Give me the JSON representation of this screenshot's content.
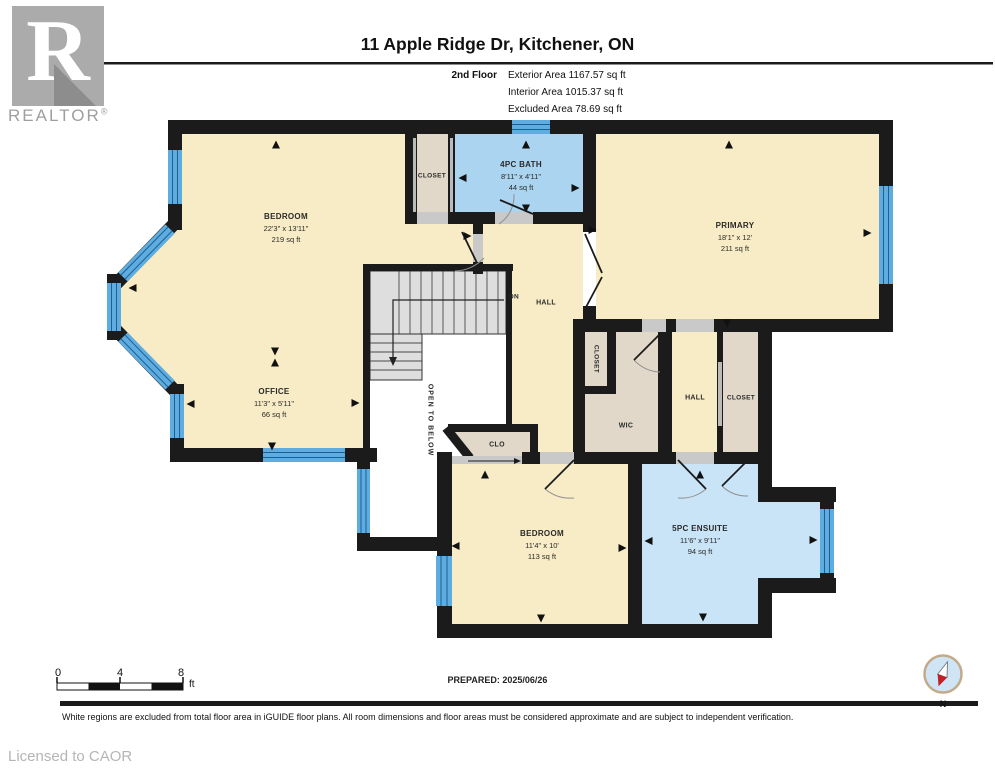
{
  "header": {
    "logo_letter": "R",
    "logo_text": "REALTOR",
    "logo_reg": "®",
    "title": "11 Apple Ridge Dr, Kitchener, ON",
    "floor_label": "2nd Floor",
    "stats": [
      "Exterior Area 1167.57 sq ft",
      "Interior Area 1015.37 sq ft",
      "Excluded Area 78.69 sq ft"
    ]
  },
  "rooms": {
    "bedroom1": {
      "name": "BEDROOM",
      "dims": "22'3\" x 13'11\"",
      "area": "219 sq ft"
    },
    "office": {
      "name": "OFFICE",
      "dims": "11'3\" x 5'11\"",
      "area": "66 sq ft"
    },
    "bath": {
      "name": "4PC BATH",
      "dims": "8'11\" x 4'11\"",
      "area": "44 sq ft"
    },
    "primary": {
      "name": "PRIMARY",
      "dims": "18'1\" x 12'",
      "area": "211 sq ft"
    },
    "bedroom2": {
      "name": "BEDROOM",
      "dims": "11'4\" x 10'",
      "area": "113 sq ft"
    },
    "ensuite": {
      "name": "5PC ENSUITE",
      "dims": "11'6\" x 9'11\"",
      "area": "94 sq ft"
    }
  },
  "labels": {
    "closet_top": "CLOSET",
    "closet_mid": "CLOSET",
    "closet_right": "CLOSET",
    "wic": "WIC",
    "hall_main": "HALL",
    "hall_right": "HALL",
    "clo": "CLO",
    "dn": "DN",
    "open_below": "OPEN TO BELOW"
  },
  "scalebar": {
    "t0": "0",
    "t4": "4",
    "t8": "8",
    "unit": "ft"
  },
  "compass": {
    "n": "N"
  },
  "footer": {
    "prepared": "PREPARED: 2025/06/26",
    "disclaimer": "White regions are excluded from total floor area in iGUIDE floor plans. All room dimensions and floor areas must be considered approximate and are subject to independent verification.",
    "licensed": "Licensed to CAOR"
  },
  "colors": {
    "wall": "#1b1b1b",
    "floor_cream": "#f8ecc6",
    "bath_blue": "#abd4f0",
    "ensuite_blue": "#c9e3f7",
    "closet_beige": "#e1d8c9",
    "window_blue": "#5fade0",
    "stairs_gray": "#dedede",
    "compass_red": "#c32026"
  }
}
